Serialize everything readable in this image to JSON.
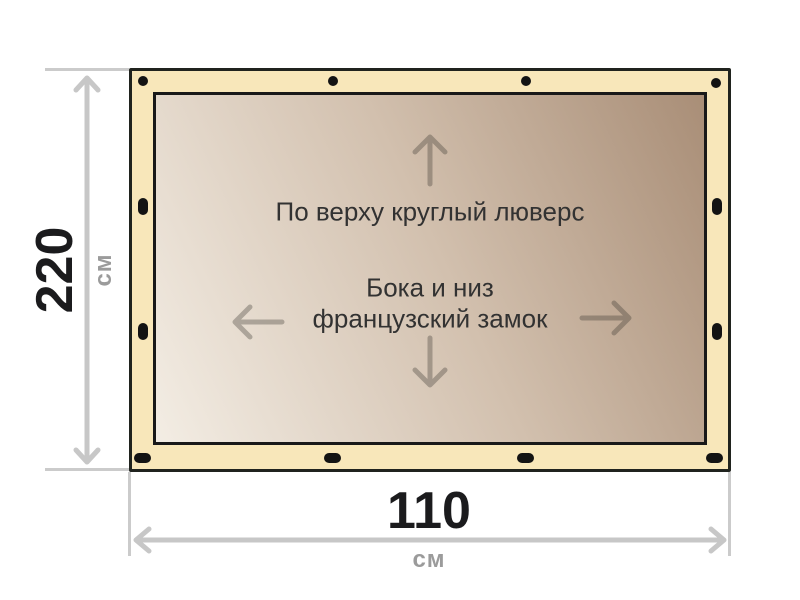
{
  "diagram": {
    "panel": {
      "top_note": "По верху круглый люверс",
      "center_note_line1": "Бока и низ",
      "center_note_line2": "французский замок"
    },
    "height_dimension": {
      "value": "220",
      "unit": "см"
    },
    "width_dimension": {
      "value": "110",
      "unit": "см"
    },
    "grommets": {
      "top_count": 4,
      "bottom_count": 4,
      "left_count": 2,
      "right_count": 2,
      "top_shape": "round",
      "side_and_bottom_shape": "oval"
    },
    "icons": [
      "arrow-up-icon",
      "arrow-down-icon",
      "arrow-left-icon",
      "arrow-right-icon",
      "grommet-icon",
      "dimension-arrow-vertical",
      "dimension-arrow-horizontal"
    ],
    "colors": {
      "frame_fill": "#F8E7BA",
      "frame_border": "#20231E",
      "panel_border": "#191919",
      "panel_gradient_light": "#F3EDE4",
      "panel_gradient_dark": "#A98E77",
      "grommet": "#131313",
      "dimension_line": "#C7C7C7",
      "dimension_number": "#1B1B1D",
      "dimension_unit": "#9B9B9B",
      "note_text": "#323232"
    }
  }
}
